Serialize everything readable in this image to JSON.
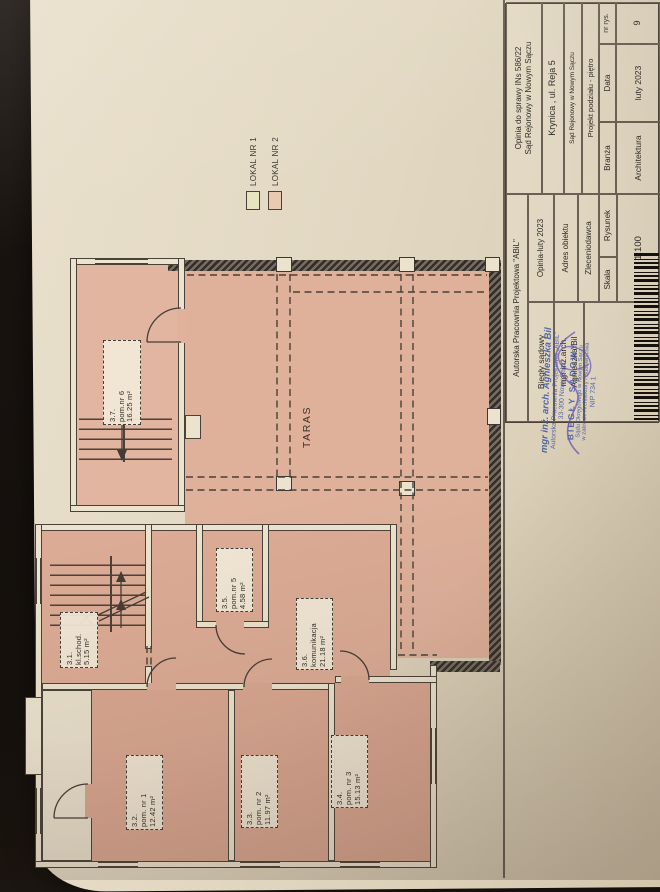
{
  "legend": {
    "items": [
      {
        "label": "LOKAL NR 1",
        "color": "#e8e4bf"
      },
      {
        "label": "LOKAL NR 2",
        "color": "#eac9b2"
      }
    ]
  },
  "plan": {
    "taras_label": "TARAS",
    "rooms": [
      {
        "id": "3.1.",
        "name": "kl.schod.",
        "area": "5.15 m²"
      },
      {
        "id": "3.2.",
        "name": "pom. nr 1",
        "area": "12.42 m²"
      },
      {
        "id": "3.3.",
        "name": "pom. nr 2",
        "area": "11.97 m²"
      },
      {
        "id": "3.4.",
        "name": "pom. nr 3",
        "area": "15.13 m²"
      },
      {
        "id": "3.5.",
        "name": "pom.nr 5",
        "area": "4.58 m²"
      },
      {
        "id": "3.6.",
        "name": "komunikacja",
        "area": "21.18 m²"
      },
      {
        "id": "3.7.",
        "name": "pom.nr 6",
        "area": "16.25 m²"
      }
    ]
  },
  "titleblock": {
    "company": "Autorska Pracownia Projektowa \"ABiL\"",
    "biegly_label": "Biegły sądowy",
    "author_line1": "mgr inż.arch.",
    "author_line2": "Agnieszka Bil",
    "opinia_label": "Opinia-luty 2023",
    "adres_label": "Adres obiektu",
    "zleceniodawca_label": "Zleceniodawca",
    "rysunek_label": "Rysunek",
    "skala_label": "Skala",
    "skala_value": "1:100",
    "case_line1": "Opinia do sprawy INs 586/22",
    "case_line2": "Sąd Rejonowy w Nowym Sączu",
    "adres_value": "Krynica , ul. Reja 5",
    "zleceniodawca_value": "Sąd Rejonowy w Nowym Sączu",
    "rysunek_value": "Projekt podziału - piętro",
    "branza_label": "Branża",
    "branza_value": "Architektura",
    "data_label": "Data",
    "data_value": "luty 2023",
    "nr_label": "nr rys.",
    "nr_value": "9"
  },
  "stamp": {
    "lines": [
      "mgr inż. arch. Agnieszka Bil",
      "Autorska Pracownia Projektowa „ABIL”",
      "33-300 Nowy Sącz",
      "BIEGŁY SĄDOWY",
      "Sądu Okręgowego w Nowym Sączu",
      "w zakresie Architektury i Budownictwa",
      "NIP 734 1"
    ]
  }
}
